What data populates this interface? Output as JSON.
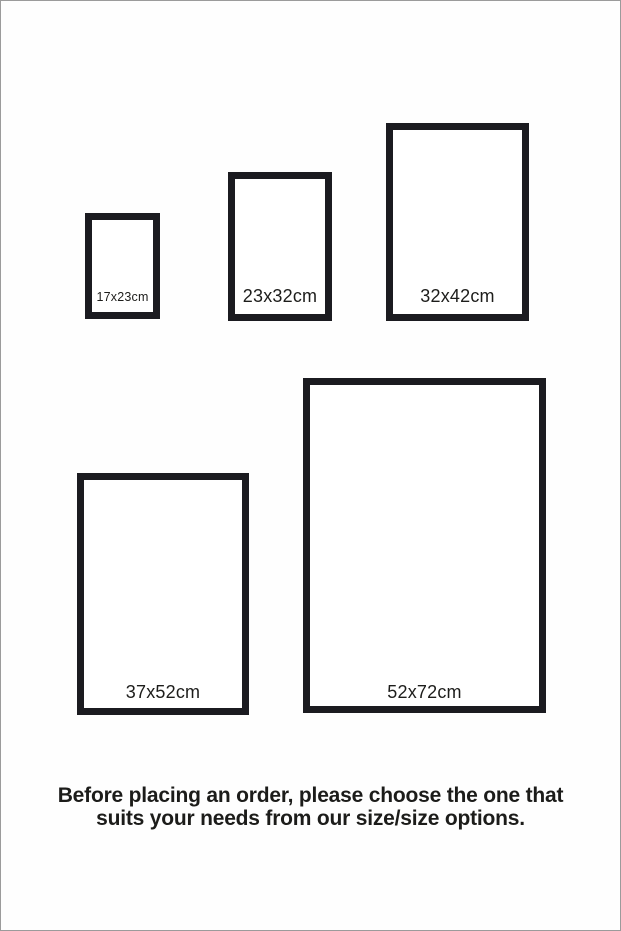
{
  "page": {
    "background": "#fefefe",
    "edge_border_color": "#9b9b9b"
  },
  "colors": {
    "frame_border": "#1b1b20",
    "label_text": "#1d1d1b",
    "footer_text": "#1c1c1a"
  },
  "frames": [
    {
      "label": "17x23cm",
      "width_cm": 17,
      "height_cm": 23
    },
    {
      "label": "23x32cm",
      "width_cm": 23,
      "height_cm": 32
    },
    {
      "label": "32x42cm",
      "width_cm": 32,
      "height_cm": 42
    },
    {
      "label": "37x52cm",
      "width_cm": 37,
      "height_cm": 52
    },
    {
      "label": "52x72cm",
      "width_cm": 52,
      "height_cm": 72
    }
  ],
  "footer": {
    "line1": "Before placing an order, please choose the one that",
    "line2": "suits your needs from our size/size options."
  }
}
